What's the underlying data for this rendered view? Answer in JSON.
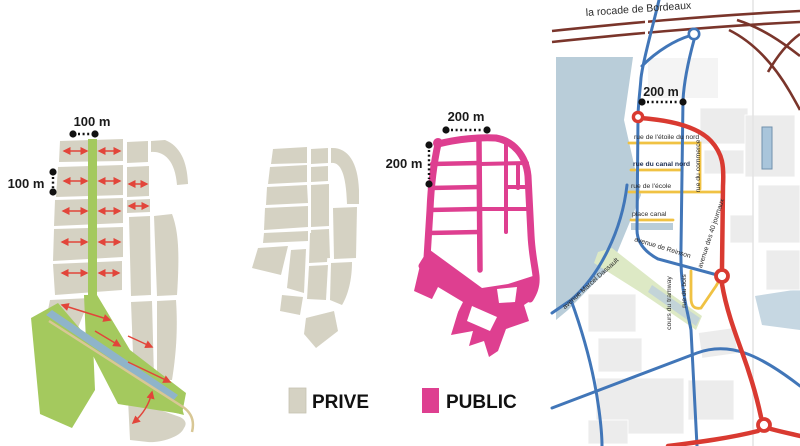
{
  "figure": {
    "legend": {
      "prive_label": "PRIVE",
      "public_label": "PUBLIC"
    },
    "scales": {
      "morphology_h": "100 m",
      "morphology_v": "100 m",
      "public_h": "200 m",
      "public_v": "200 m",
      "map": "200 m"
    },
    "map_labels": {
      "rocade": "la rocade de Bordeaux",
      "etoile": "rue de l'étoile du nord",
      "canal_nord": "rue du canal nord",
      "commerce": "rue du commerce",
      "ecole": "rue de l'école",
      "place_canal": "place canal",
      "reinson": "avenue de Reinson",
      "journaux": "avenue des 40 journaux",
      "dassault": "avenue Marcel Dassault",
      "tramway": "cours du tramway",
      "bois": "rue du bois"
    },
    "colors": {
      "private_beige": "#d5d2c3",
      "public_pink": "#de3f90",
      "green": "#a4c95e",
      "arrow_red": "#e2453a",
      "route_red": "#d93a31",
      "route_blue": "#4176b8",
      "street_yellow": "#f0c243",
      "rocade_brown": "#7a352b",
      "water_blue": "#b9cdd9"
    }
  }
}
